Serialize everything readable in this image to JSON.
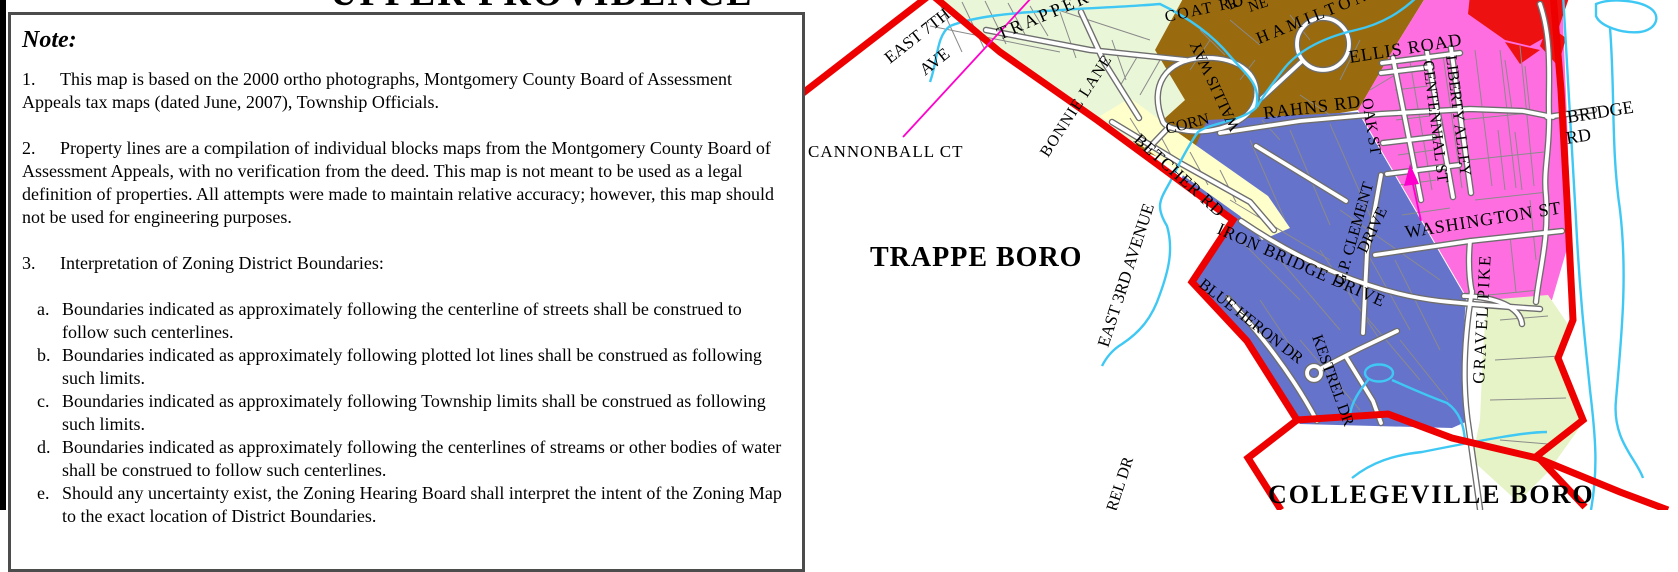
{
  "title": {
    "map_title": "UPPER PROVIDENCE TWP"
  },
  "note": {
    "heading": "Note:",
    "items": [
      {
        "num": "1.",
        "text": "This map is based on the 2000 ortho photographs, Montgomery County Board of Assessment Appeals tax maps (dated June, 2007), Township Officials."
      },
      {
        "num": "2.",
        "text": "Property lines are a compilation of individual blocks maps from the Montgomery County Board of Assessment Appeals, with no verification from the deed.  This map is not meant to be used as a legal definition of properties.  All attempts were made to maintain relative accuracy; however, this map should not be used for engineering purposes."
      },
      {
        "num": "3.",
        "text": "Interpretation of Zoning District Boundaries:"
      }
    ],
    "subitems": [
      {
        "num": "a.",
        "text": "Boundaries indicated as approximately following the centerline of streets shall be construed to follow such centerlines."
      },
      {
        "num": "b.",
        "text": "Boundaries indicated as approximately following plotted lot lines shall be construed as following such limits."
      },
      {
        "num": "c.",
        "text": "Boundaries indicated as approximately following Township limits shall be construed as following such limits."
      },
      {
        "num": "d.",
        "text": "Boundaries indicated as approximately following the centerlines of streams or other bodies of water shall be construed to follow such centerlines."
      },
      {
        "num": "e.",
        "text": "Should any uncertainty exist, the Zoning Hearing Board shall interpret the intent of the Zoning Map to the exact location of District Boundaries."
      }
    ]
  },
  "map": {
    "boros": {
      "trappe": "TRAPPE BORO",
      "collegeville": "COLLEGEVILLE BORO"
    },
    "streets": {
      "east7th_l1": "EAST 7TH",
      "east7th_l2": "AVE",
      "trapper": "TRAPPER",
      "cannonball": "CANNONBALL CT",
      "bonnie": "BONNIE LANE",
      "betcher": "BETCHER RD",
      "corn": "CORN",
      "wallis": "WALLIS WAY",
      "coat_rd": "COAT RD",
      "ne_frag": "NE",
      "r_frag": "R",
      "hamilton": "HAMILTON",
      "ellis": "ELLIS ROAD",
      "rahns": "RAHNS RD",
      "oak": "OAK ST",
      "centennial": "CENTENNIAL ST",
      "liberty": "LIBERTY ALLEY",
      "washington": "WASHINGTON ST",
      "bridge_l1": "BRIDGE",
      "bridge_l2": "RD",
      "iron_bridge": "IRON BRIDGE DRIVE",
      "gp_clement": "G.P. CLEMENT",
      "gp_clement_l2": "DRIVE",
      "east3rd": "EAST 3RD AVENUE",
      "blue_heron": "BLUE HERON DR",
      "kestrel": "KESTREL DR",
      "kestrel_frag": "REL DR",
      "gravel_pike": "GRAVEL PIKE"
    },
    "colors": {
      "boundary_red": "#ee0000",
      "water_cyan": "#3fc8f3",
      "highlight_magenta": "#ff00cc",
      "zone_light_green": "#eaf6d8",
      "zone_brown": "#996a0e",
      "zone_pink": "#ff6ee0",
      "zone_red": "#ee1111",
      "zone_blue": "#6673cb",
      "zone_pale_yellow": "#ffffcc",
      "zone_yellow_green": "#e6f3c6",
      "pond_fill": "#ffffff",
      "pond_fill_blue": "#cfeefc"
    }
  }
}
